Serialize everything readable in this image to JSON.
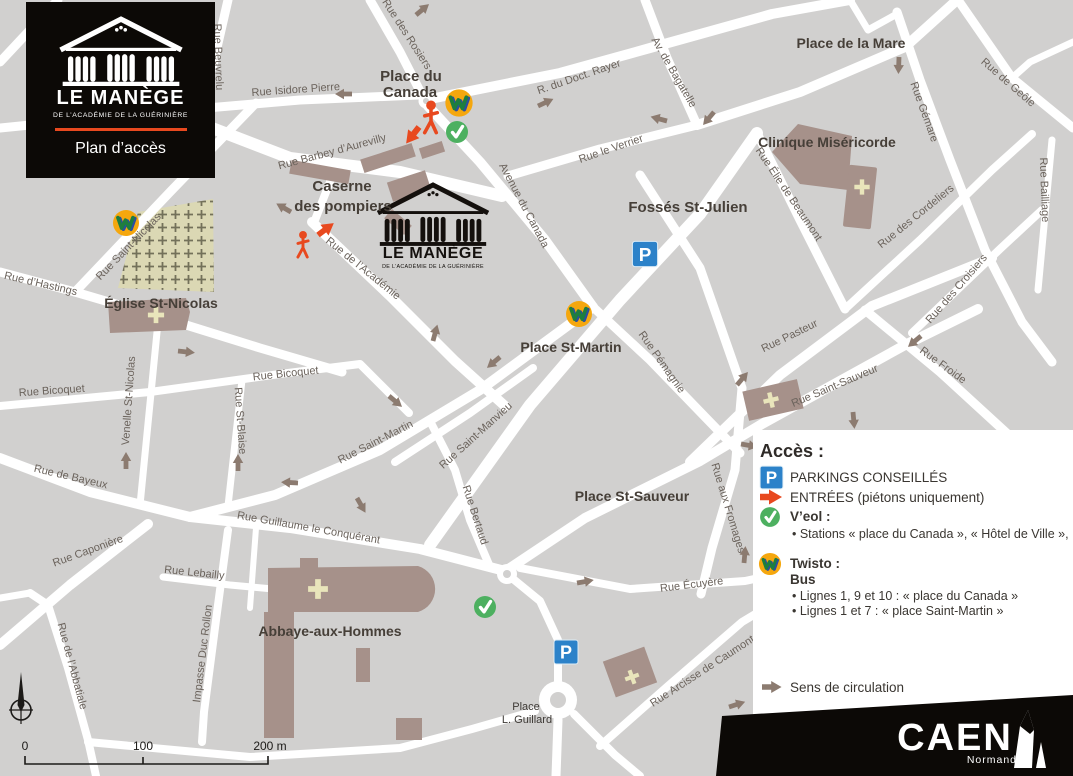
{
  "logo": {
    "title": "LE MANÈGE",
    "subtitle": "DE L’ACADÉMIE DE LA GUÉRINIÈRE",
    "access_label": "Plan d’accès"
  },
  "map": {
    "street_labels": [
      "Rue Beuvrelu",
      "Rue Isidore Pierre",
      "Rue des Rosiers",
      "R. du Doct. Rayer",
      "Av. de Bagatelle",
      "Rue le Verrier",
      "Rue Gémare",
      "Rue de Geôle",
      "Rue Bailliage",
      "Rue Élie de Beaumont",
      "Rue des Cordeliers",
      "Rue des Croisiers",
      "Rue Saint-Nicolas",
      "Rue d’Hastings",
      "Rue Barbey d’Aurevilly",
      "Rue de l’Académie",
      "Avenue du Canada",
      "Venelle St-Nicolas",
      "Rue Bicoquet",
      "Rue Bicoquet",
      "Rue St-Blaise",
      "Rue de Bayeux",
      "Rue Saint-Martin",
      "Rue Saint-Manvieu",
      "Rue Bertaud",
      "Rue aux Fromages",
      "Rue Pémagnie",
      "Rue Pasteur",
      "Rue Saint-Sauveur",
      "Rue Froide",
      "Rue Caponière",
      "Rue Lebailly",
      "Rue Guillaume le Conquérant",
      "Rue Écuyère",
      "Rue Arcisse de Caumont",
      "Impasse Duc Rollon",
      "Rue de l’Abbatiale"
    ],
    "places": [
      "Place du",
      "Canada",
      "Place de la Mare",
      "Clinique Miséricorde",
      "Fossés St-Julien",
      "Caserne",
      "des pompiers",
      "Église St-Nicolas",
      "Place St-Martin",
      "Place St-Sauveur",
      "Abbaye-aux-Hommes",
      "Place",
      "L. Guillard"
    ],
    "map_logo": {
      "title": "LE MANÈGE",
      "subtitle": "DE L’ACADÉMIE DE LA GUÉRINIÈRE"
    },
    "scale": {
      "zero": "0",
      "hundred": "100",
      "two_hundred": "200 m"
    }
  },
  "legend": {
    "title": "Accès :",
    "parking_symbol": "P",
    "parking_label": "PARKINGS CONSEILLÉS",
    "entrances_label": "ENTRÉES (piétons uniquement)",
    "veol_title": "V’eol :",
    "veol_line": "• Stations « place du Canada », « Hôtel de Ville »,",
    "twisto_title": "Twisto :",
    "twisto_sub": "Bus",
    "twisto_line1": "• Lignes 1, 9 et 10 : « place du Canada »",
    "twisto_line2": "• Lignes 1 et 7 : « place Saint-Martin »",
    "direction_label": "Sens de circulation"
  },
  "footer": {
    "city": "CAEN",
    "region": "Normandie"
  },
  "icons": {
    "twisto_icon_color": "#f5a70e",
    "veol_icon_color": "#4db060",
    "parking_icon_color": "#2c82c9",
    "entrance_arrow_color": "#e8491f",
    "direction_arrow_color": "#8c7b70"
  },
  "colors": {
    "map_background": "#d1d0cf",
    "street": "#ffffff",
    "building": "#a6918a",
    "building_cross": "#e9e5bb",
    "cemetery": "#dbd8b4",
    "accent_red": "#e8491f",
    "panel": "#ffffff",
    "banner": "#0c0906"
  }
}
